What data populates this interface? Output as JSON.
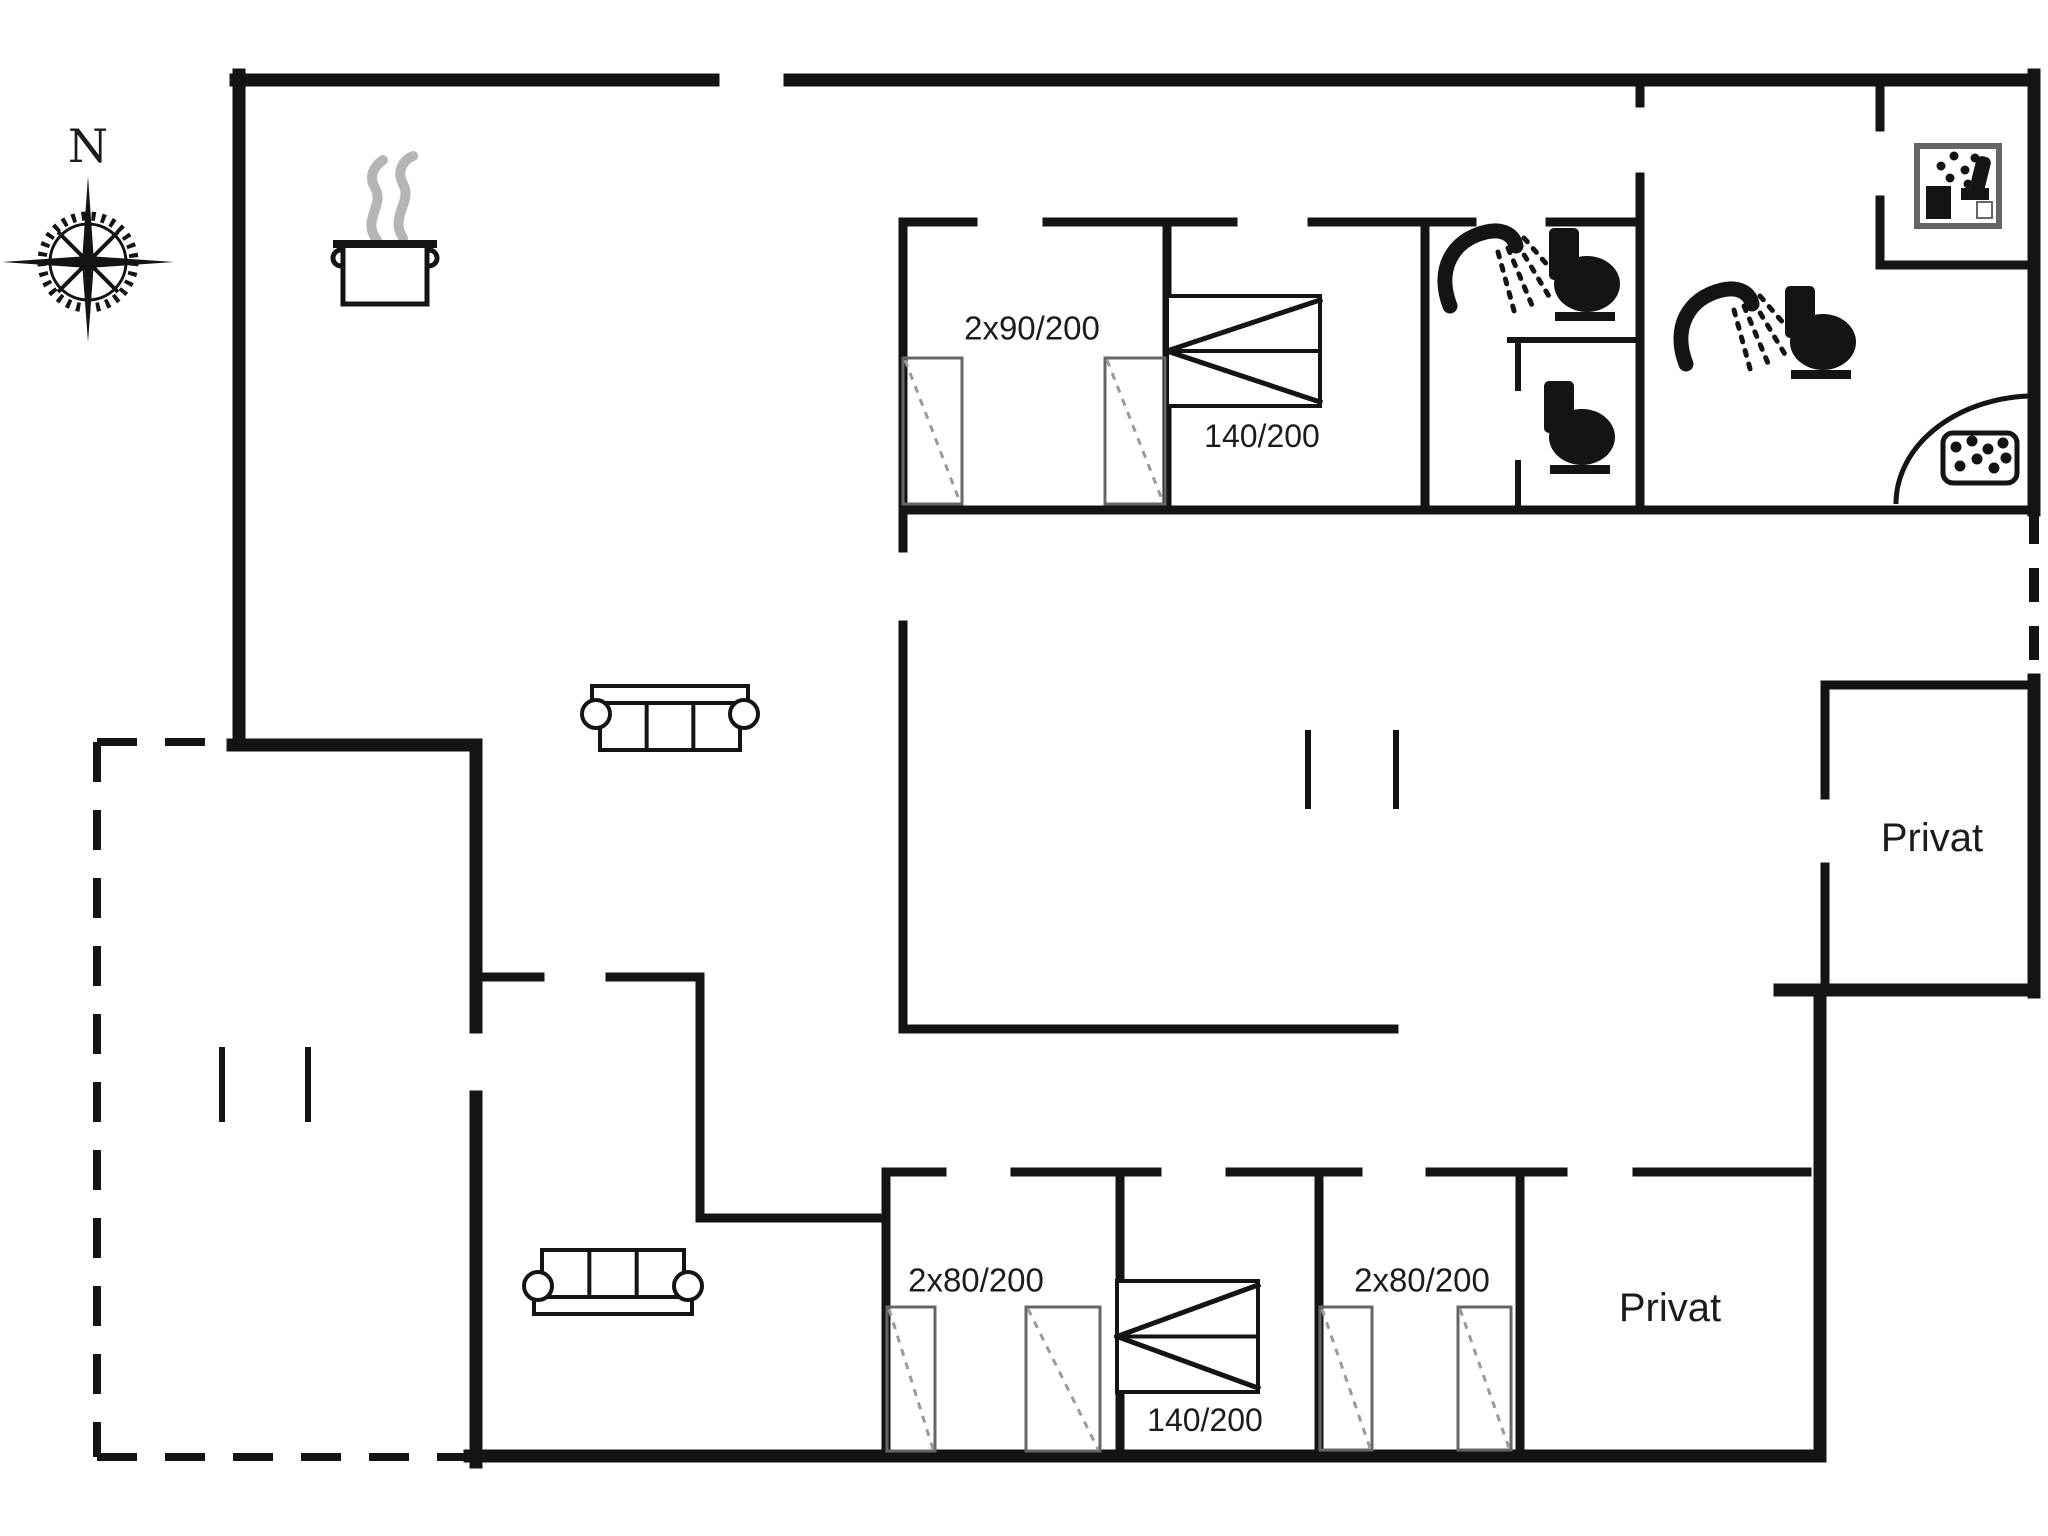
{
  "title": "Holiday house floor plan",
  "colors": {
    "background": "#ffffff",
    "ink": "#141414",
    "soft": "#666666",
    "dashline": "#9a9a9a",
    "steam": "#b5b5b5"
  },
  "compass": {
    "label": "N",
    "cx": 88,
    "cy": 262
  },
  "room_labels": [
    {
      "name": "bed-size-label-top-bedroom-1",
      "text": "2x90/200",
      "x": 1032,
      "y": 328,
      "size": 33
    },
    {
      "name": "bed-size-label-top-bedroom-2",
      "text": "140/200",
      "x": 1262,
      "y": 436,
      "size": 32
    },
    {
      "name": "bed-size-label-bottom-bedroom-1",
      "text": "2x80/200",
      "x": 976,
      "y": 1280,
      "size": 33
    },
    {
      "name": "bed-size-label-bottom-bedroom-2",
      "text": "140/200",
      "x": 1205,
      "y": 1420,
      "size": 32
    },
    {
      "name": "bed-size-label-bottom-bedroom-3",
      "text": "2x80/200",
      "x": 1422,
      "y": 1280,
      "size": 33
    },
    {
      "name": "room-label-privat-upper",
      "text": "Privat",
      "x": 1932,
      "y": 838,
      "size": 40
    },
    {
      "name": "room-label-privat-lower",
      "text": "Privat",
      "x": 1670,
      "y": 1308,
      "size": 40
    }
  ],
  "walls": {
    "outer": [
      [
        236,
        80,
        713,
        80
      ],
      [
        790,
        80,
        2034,
        80
      ],
      [
        2034,
        75,
        2034,
        510
      ],
      [
        239,
        75,
        239,
        745
      ],
      [
        233,
        745,
        476,
        745
      ],
      [
        476,
        745,
        476,
        1027
      ],
      [
        476,
        1097,
        476,
        1462
      ],
      [
        470,
        1456,
        1820,
        1456
      ],
      [
        1820,
        1456,
        1820,
        990
      ],
      [
        1780,
        990,
        2034,
        990
      ],
      [
        2034,
        992,
        2034,
        680
      ]
    ],
    "inner": [
      [
        903,
        222,
        973,
        222
      ],
      [
        1047,
        222,
        1233,
        222
      ],
      [
        1312,
        222,
        1472,
        222
      ],
      [
        1550,
        222,
        1640,
        222
      ],
      [
        903,
        222,
        903,
        548
      ],
      [
        903,
        625,
        903,
        1029
      ],
      [
        1167,
        222,
        1167,
        510
      ],
      [
        1425,
        222,
        1425,
        510
      ],
      [
        903,
        510,
        2034,
        510
      ],
      [
        1640,
        80,
        1640,
        103
      ],
      [
        1640,
        177,
        1640,
        510
      ],
      [
        1880,
        80,
        1880,
        127
      ],
      [
        1880,
        200,
        1880,
        265
      ],
      [
        1880,
        265,
        2034,
        265
      ],
      [
        903,
        1029,
        1394,
        1029
      ],
      [
        480,
        977,
        540,
        977
      ],
      [
        610,
        977,
        700,
        977
      ],
      [
        700,
        977,
        700,
        1218
      ],
      [
        700,
        1218,
        886,
        1218
      ],
      [
        886,
        1172,
        942,
        1172
      ],
      [
        1015,
        1172,
        1157,
        1172
      ],
      [
        1230,
        1172,
        1358,
        1172
      ],
      [
        1430,
        1172,
        1563,
        1172
      ],
      [
        1637,
        1172,
        1807,
        1172
      ],
      [
        886,
        1172,
        886,
        1456
      ],
      [
        1120,
        1172,
        1120,
        1456
      ],
      [
        1319,
        1172,
        1319,
        1456
      ],
      [
        1520,
        1172,
        1520,
        1456
      ],
      [
        1825,
        685,
        2034,
        685
      ],
      [
        1825,
        685,
        1825,
        795
      ],
      [
        1825,
        867,
        1825,
        990
      ]
    ],
    "thin": [
      [
        1510,
        340,
        1640,
        340
      ],
      [
        1518,
        340,
        1518,
        388
      ],
      [
        1518,
        463,
        1518,
        510
      ]
    ],
    "dashed_terrace": [
      [
        97,
        742,
        233,
        742
      ],
      [
        97,
        742,
        97,
        1457
      ],
      [
        97,
        1457,
        470,
        1457
      ]
    ],
    "dashed_right": [
      [
        2034,
        510,
        2034,
        680
      ]
    ]
  },
  "door_ticks": [
    [
      1308,
      733,
      1308,
      806
    ],
    [
      1396,
      733,
      1396,
      806
    ],
    [
      222,
      1050,
      222,
      1119
    ],
    [
      308,
      1050,
      308,
      1119
    ]
  ],
  "furniture": [
    {
      "name": "cooking-pot-icon",
      "type": "pot",
      "x": 335,
      "y": 160
    },
    {
      "name": "sofa-icon-living",
      "type": "sofa",
      "x": 582,
      "y": 686,
      "w": 176,
      "h": 80,
      "facing": "up"
    },
    {
      "name": "sofa-icon-lounge",
      "type": "sofa",
      "x": 524,
      "y": 1236,
      "w": 178,
      "h": 78,
      "facing": "down"
    },
    {
      "name": "double-bed-icon-top",
      "type": "bed",
      "x": 1167,
      "y": 296,
      "w": 153,
      "h": 110
    },
    {
      "name": "double-bed-icon-bottom",
      "type": "bed",
      "x": 1117,
      "y": 1281,
      "w": 141,
      "h": 111
    },
    {
      "name": "wardrobe-icon-1",
      "type": "wardrobe",
      "x": 903,
      "y": 358,
      "w": 59,
      "h": 146
    },
    {
      "name": "wardrobe-icon-2",
      "type": "wardrobe",
      "x": 1105,
      "y": 358,
      "w": 60,
      "h": 146
    },
    {
      "name": "wardrobe-icon-3",
      "type": "wardrobe",
      "x": 887,
      "y": 1307,
      "w": 48,
      "h": 144
    },
    {
      "name": "wardrobe-icon-4",
      "type": "wardrobe",
      "x": 1026,
      "y": 1307,
      "w": 74,
      "h": 144
    },
    {
      "name": "wardrobe-icon-5",
      "type": "wardrobe",
      "x": 1320,
      "y": 1307,
      "w": 52,
      "h": 143
    },
    {
      "name": "wardrobe-icon-6",
      "type": "wardrobe",
      "x": 1458,
      "y": 1307,
      "w": 53,
      "h": 143
    },
    {
      "name": "shower-head-icon-1",
      "type": "shower",
      "x": 1442,
      "y": 226
    },
    {
      "name": "shower-head-icon-2",
      "type": "shower",
      "x": 1678,
      "y": 284
    },
    {
      "name": "toilet-icon-1",
      "type": "toilet",
      "x": 1543,
      "y": 228
    },
    {
      "name": "toilet-icon-2",
      "type": "toilet",
      "x": 1538,
      "y": 381
    },
    {
      "name": "toilet-icon-3",
      "type": "toilet",
      "x": 1779,
      "y": 286
    },
    {
      "name": "washing-machine-icon",
      "type": "washer",
      "x": 1917,
      "y": 146,
      "w": 82,
      "h": 80
    },
    {
      "name": "corner-shower-icon",
      "type": "cornerShower"
    }
  ]
}
